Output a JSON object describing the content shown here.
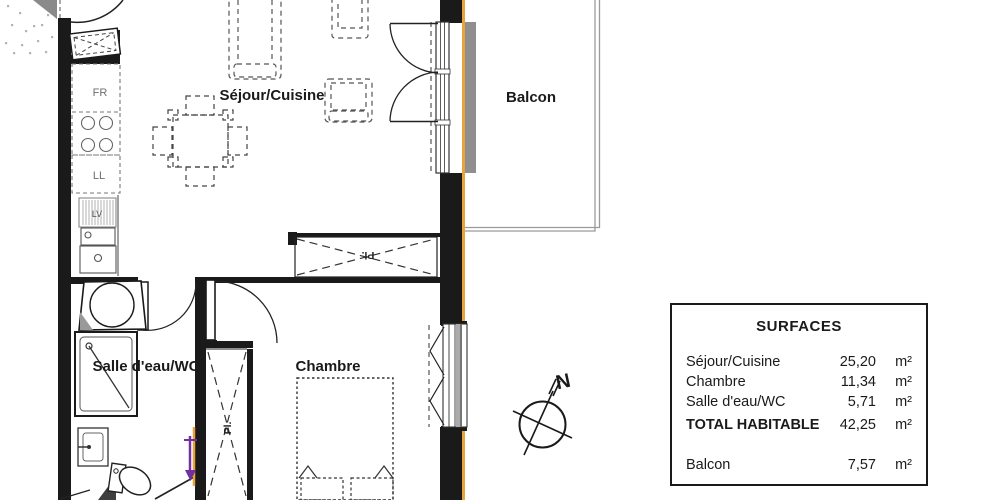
{
  "colors": {
    "wall": "#1a1a1a",
    "facade_accent": "#E8A33D",
    "annotation_purple": "#7030A0",
    "sill_gray": "#8f8f8f",
    "balcony_outline": "#9a9a9a"
  },
  "plan": {
    "labels": {
      "sejour_cuisine": "Séjour/Cuisine",
      "balcon": "Balcon",
      "chambre": "Chambre",
      "salle_eau_wc": "Salle d'eau/WC"
    },
    "annotations": {
      "fridge": "FR",
      "washer": "LL",
      "dishwasher": "LV",
      "closet_top": "Pl.",
      "closet_side": "Pl.",
      "compass_north": "N"
    }
  },
  "surfaces_table": {
    "title": "SURFACES",
    "rows": [
      {
        "label": "Séjour/Cuisine",
        "value": "25,20",
        "unit": "m²"
      },
      {
        "label": "Chambre",
        "value": "11,34",
        "unit": "m²"
      },
      {
        "label": "Salle d'eau/WC",
        "value": "5,71",
        "unit": "m²"
      }
    ],
    "total": {
      "label": "TOTAL HABITABLE",
      "value": "42,25",
      "unit": "m²"
    },
    "outdoor": {
      "label": "Balcon",
      "value": "7,57",
      "unit": "m²"
    }
  }
}
